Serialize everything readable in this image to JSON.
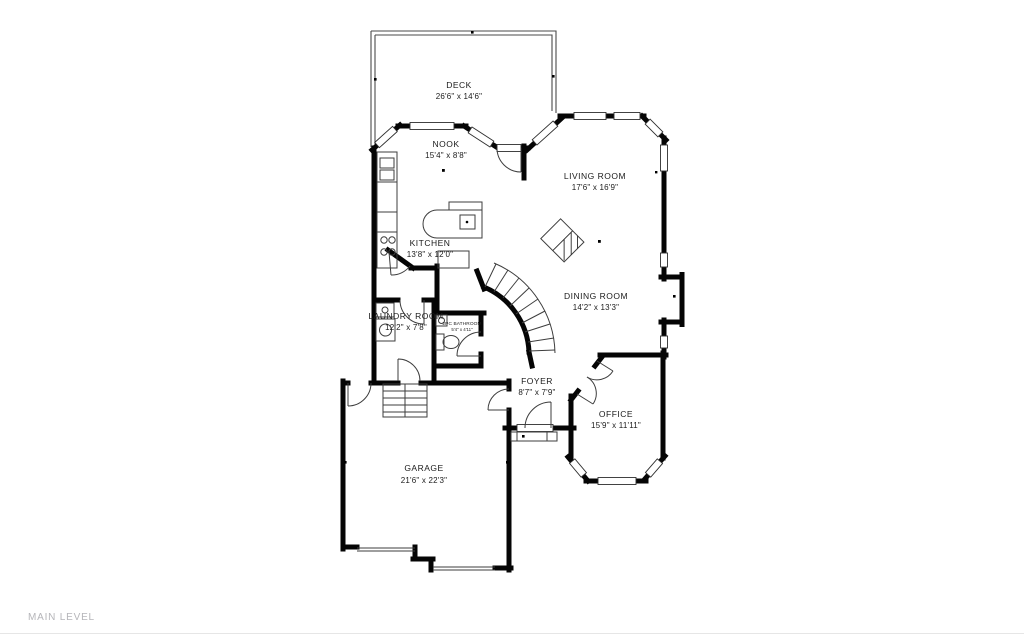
{
  "footer": {
    "level_label": "MAIN LEVEL"
  },
  "rooms": {
    "deck": {
      "name": "DECK",
      "dims": "26'6\" x 14'6\""
    },
    "nook": {
      "name": "NOOK",
      "dims": "15'4\" x 8'8\""
    },
    "living_room": {
      "name": "LIVING ROOM",
      "dims": "17'6\" x 16'9\""
    },
    "kitchen": {
      "name": "KITCHEN",
      "dims": "13'8\" x 12'0\""
    },
    "dining_room": {
      "name": "DINING ROOM",
      "dims": "14'2\" x 13'3\""
    },
    "laundry_room": {
      "name": "LAUNDRY ROOM",
      "dims": "12'2\" x 7'8\""
    },
    "bathroom": {
      "name": "2PC BATHROOM",
      "dims": "5'4\" x 4'11\""
    },
    "foyer": {
      "name": "FOYER",
      "dims": "8'7\" x 7'9\""
    },
    "office": {
      "name": "OFFICE",
      "dims": "15'9\" x 11'11\""
    },
    "garage": {
      "name": "GARAGE",
      "dims": "21'6\" x 22'3\""
    }
  },
  "colors": {
    "wall": "#050505",
    "thin_line": "#3d3d3d",
    "label_text": "#1b1b1b",
    "footer_text": "#b5b5b9",
    "background": "#ffffff",
    "hairline": "#e6e6e6"
  }
}
